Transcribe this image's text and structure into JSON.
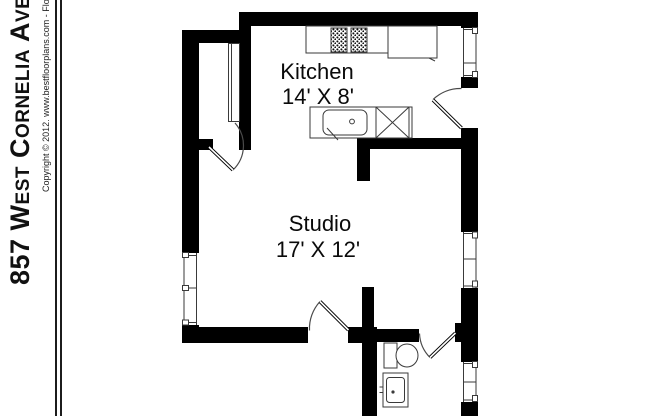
{
  "sidebar": {
    "title": "857 West Cornelia Avenue",
    "copyright_line": "Copyright © 2012. www.bestfloorplans.com - Floorplans"
  },
  "floorplan": {
    "rooms": [
      {
        "name": "Kitchen",
        "dimensions": "14' X 8'"
      },
      {
        "name": "Studio",
        "dimensions": "17' X 12'"
      }
    ],
    "fixtures": [
      "stove-burners",
      "refrigerator",
      "kitchen-counter",
      "kitchen-sink",
      "dishwasher",
      "closet-shelf",
      "toilet",
      "bathroom-sink"
    ],
    "colors": {
      "wall": "#000000",
      "fixture_line": "#3a3a3a",
      "background": "#ffffff"
    }
  }
}
